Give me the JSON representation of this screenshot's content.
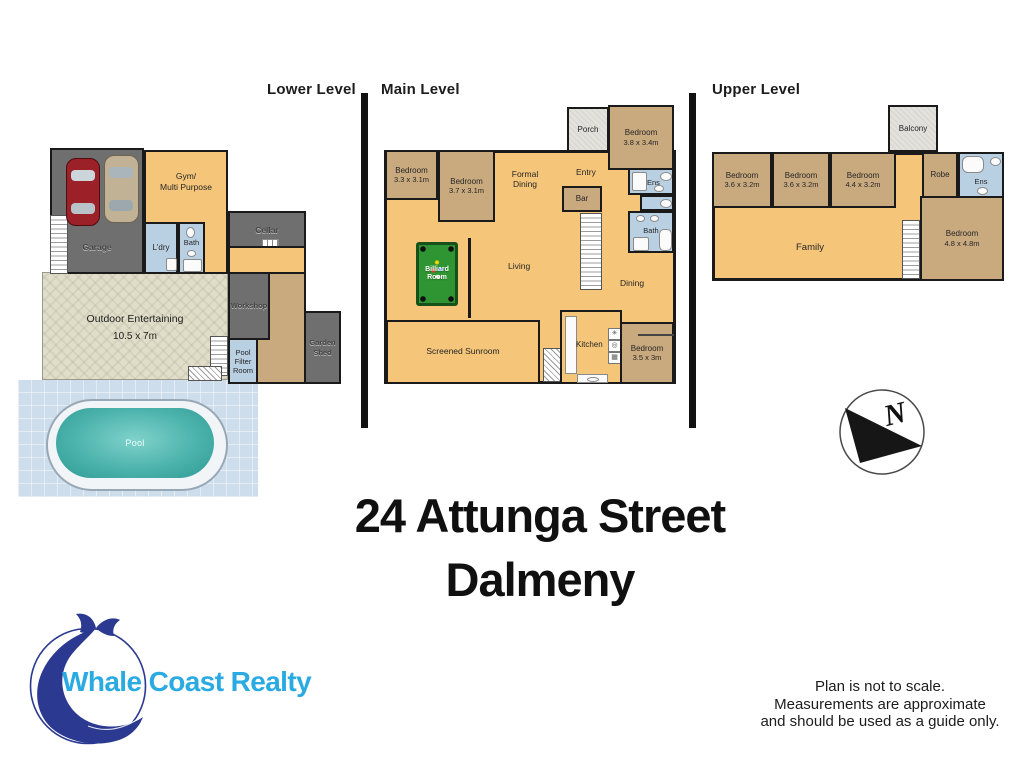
{
  "palette": {
    "floor_orange": "#f5c579",
    "room_tan": "#c9a97e",
    "room_gray": "#6f6f6f",
    "wet_blue": "#b9cfe2",
    "pool_teal": "#46b4ad",
    "wall": "#1a1a1a",
    "logo_navy": "#2b3990",
    "logo_cyan": "#29abe2"
  },
  "headers": {
    "lower": "Lower Level",
    "main": "Main Level",
    "upper": "Upper Level"
  },
  "lower_level": {
    "garage": "Garage",
    "gym": {
      "line1": "Gym/",
      "line2": "Multi Purpose"
    },
    "laundry": "L'dry",
    "bath": "Bath",
    "cellar": "Cellar",
    "workshop": "Workshop",
    "pool_filter": {
      "line1": "Pool",
      "line2": "Filter",
      "line3": "Room"
    },
    "garden_shed": {
      "line1": "Garden",
      "line2": "Shed"
    },
    "outdoor": {
      "name": "Outdoor Entertaining",
      "dims": "10.5 x 7m"
    },
    "pool": "Pool"
  },
  "main_level": {
    "porch": "Porch",
    "bedroom_ne": {
      "name": "Bedroom",
      "dims": "3.8 x 3.4m"
    },
    "entry": "Entry",
    "bedroom_w1": {
      "name": "Bedroom",
      "dims": "3.3 x 3.1m"
    },
    "bedroom_w2": {
      "name": "Bedroom",
      "dims": "3.7 x 3.1m"
    },
    "formal_dining": {
      "line1": "Formal",
      "line2": "Dining"
    },
    "bar": "Bar",
    "ens": "Ens",
    "bath": "Bath",
    "billiard": {
      "line1": "Billiard",
      "line2": "Room"
    },
    "living": "Living",
    "dining": "Dining",
    "sunroom": "Screened Sunroom",
    "kitchen": "Kitchen",
    "bedroom_se": {
      "name": "Bedroom",
      "dims": "3.5 x 3m"
    }
  },
  "upper_level": {
    "balcony": "Balcony",
    "bedroom_1": {
      "name": "Bedroom",
      "dims": "3.6 x 3.2m"
    },
    "bedroom_2": {
      "name": "Bedroom",
      "dims": "3.6 x 3.2m"
    },
    "bedroom_3": {
      "name": "Bedroom",
      "dims": "4.4 x 3.2m"
    },
    "robe": "Robe",
    "ens": "Ens",
    "family": "Family",
    "bedroom_main": {
      "name": "Bedroom",
      "dims": "4.8 x 4.8m"
    }
  },
  "icons": {
    "kitchen_vent": "✳",
    "kitchen_oven": "◎",
    "kitchen_cooktop": "▦"
  },
  "compass": {
    "north": "N"
  },
  "address": {
    "line1": "24 Attunga Street",
    "line2": "Dalmeny"
  },
  "agency": {
    "name": "Whale Coast Realty"
  },
  "disclaimer": {
    "line1": "Plan is not to scale.",
    "line2": "Measurements are approximate",
    "line3": "and should be used as a guide only."
  }
}
